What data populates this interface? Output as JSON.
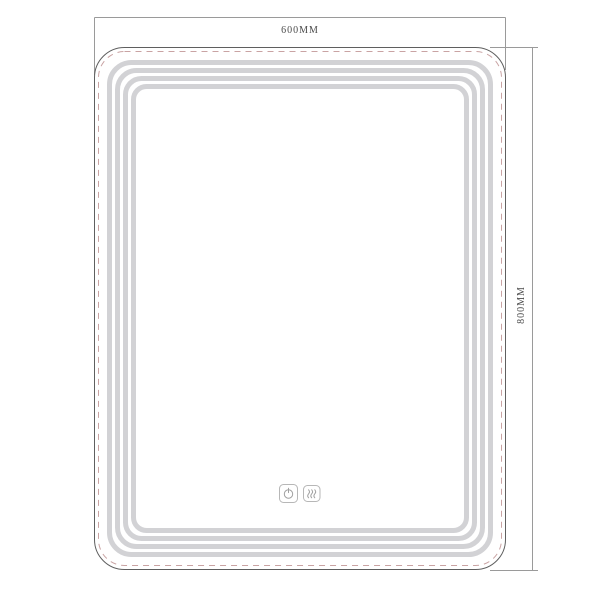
{
  "drawing": {
    "description": "LED mirror technical drawing",
    "dimensions": {
      "width_label": "600MM",
      "height_label": "800MM"
    },
    "mirror": {
      "led_band_count": 4,
      "touch_buttons": [
        {
          "icon": "power-icon"
        },
        {
          "icon": "defog-icon"
        }
      ]
    },
    "colors": {
      "background": "#ffffff",
      "outline": "#5f5f5f",
      "dashed_line": "#c9a3a3",
      "led_band": "#d2d2d5",
      "dimension_line": "#9a9a9a",
      "label_text": "#4a4a4a",
      "button_stroke": "#b7b7b7",
      "icon_stroke": "#a0a0a0"
    }
  }
}
